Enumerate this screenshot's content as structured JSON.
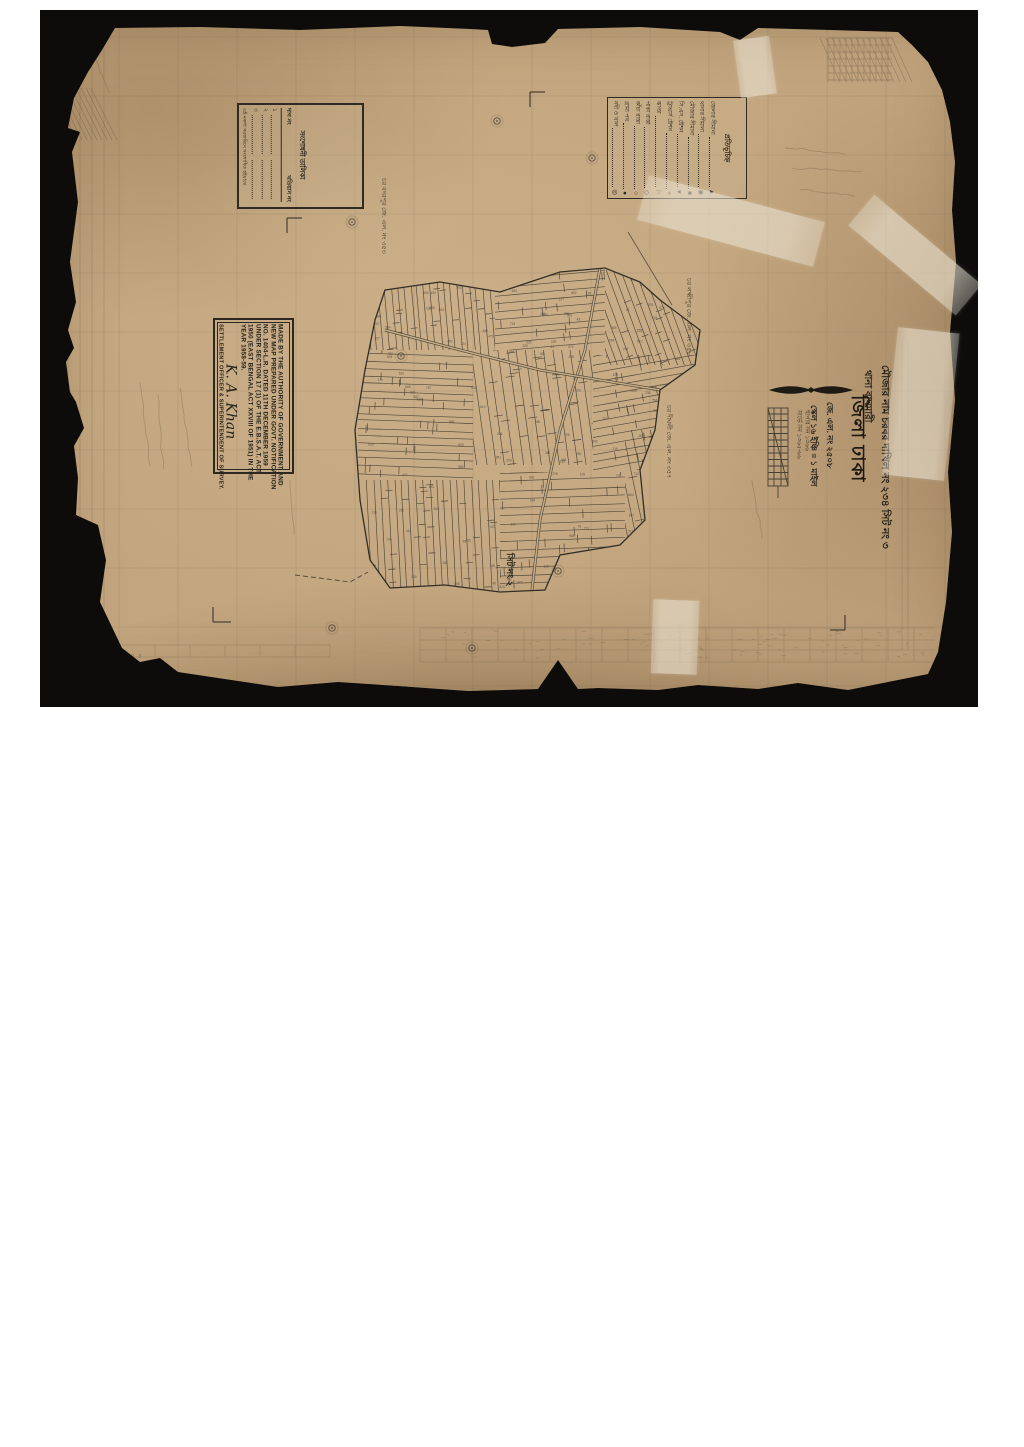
{
  "scan": {
    "bed_color": "#0d0c0a",
    "paper_color": "#c3a67f",
    "ink_color": "#2e2921",
    "pencil_color": "#6b5844"
  },
  "stamp": {
    "lines": [
      "MADE BY THE AUTHORITY OF GOVERNMENT AND",
      "NEW MAP PREPARED UNDER GOVT. NOTIFICATION",
      "NO. 1404-L.R. DATED 11TH DECEMBER 1959",
      "UNDER SECTION 17 (1) OF THE E.B.S.A.T. ACT.",
      "1950 (EAST BENGAL ACT XXVIII OF 1951) IN THE",
      "YEAR 1958-59."
    ],
    "signature": "K. A. Khan",
    "footer": "SETTLEMENT OFFICER & SUPERINTENDENT OF SURVEY."
  },
  "legend": {
    "header": "প্রতিভূচিহ্ন",
    "items": [
      {
        "label": "জেলার সীমানা",
        "symbol": "▲"
      },
      {
        "label": "থানার সীমানা",
        "symbol": "◉"
      },
      {
        "label": "মৌজার সীমানা",
        "symbol": "■"
      },
      {
        "label": "সি.এস. ষ্টেশন",
        "symbol": "▼"
      },
      {
        "label": "ট্রাভার্স ষ্টেশন",
        "symbol": "+"
      },
      {
        "label": "ঝাণ্ডা",
        "symbol": "⚐"
      },
      {
        "label": "পাকা রাস্তা",
        "symbol": "◇"
      },
      {
        "label": "কাঁচা রাস্তা",
        "symbol": "○"
      },
      {
        "label": "গ্রাম্য পথ",
        "symbol": "●"
      },
      {
        "label": "নদী ও খাল",
        "symbol": "◎"
      }
    ]
  },
  "revision_table": {
    "title": "সংশোধনী তালিকা",
    "col1": "দাগ নং",
    "col2": "খতিয়ান নং",
    "rows": [
      "১",
      "২",
      "৩"
    ],
    "footer": "এই নকশা সরজমিনে সংশোধিত হইয়াছে"
  },
  "title_block": {
    "mouza_line": "মৌজার নাম চরবর দাখিল নং ২৩৪ সিট নং ৩",
    "thana_line": "থানা বাঘমারী",
    "district_line": "জিলা ঢাকা",
    "jl_line": "জে. এল. নং ২৫০৮",
    "scale_line": "স্কেল ১৬ ইঞ্চি = ১ মাইল",
    "note1": "ছাপার সন ১৩৬৬",
    "note2": "সার্ভে সন ১৩৬৫-৬৬"
  },
  "margin_labels": {
    "west": "চর বদরপুর জে. এল. নং ৩৫৩",
    "east": "চর লক্ষ্মীপুর জে. এল. নং ৩৫৮",
    "southeast": "চর দীঘলী জে. এল. নং ৩৫৭",
    "sheet_south": "সিট নং ২",
    "bottom_faint": "SHEET NO 3"
  }
}
